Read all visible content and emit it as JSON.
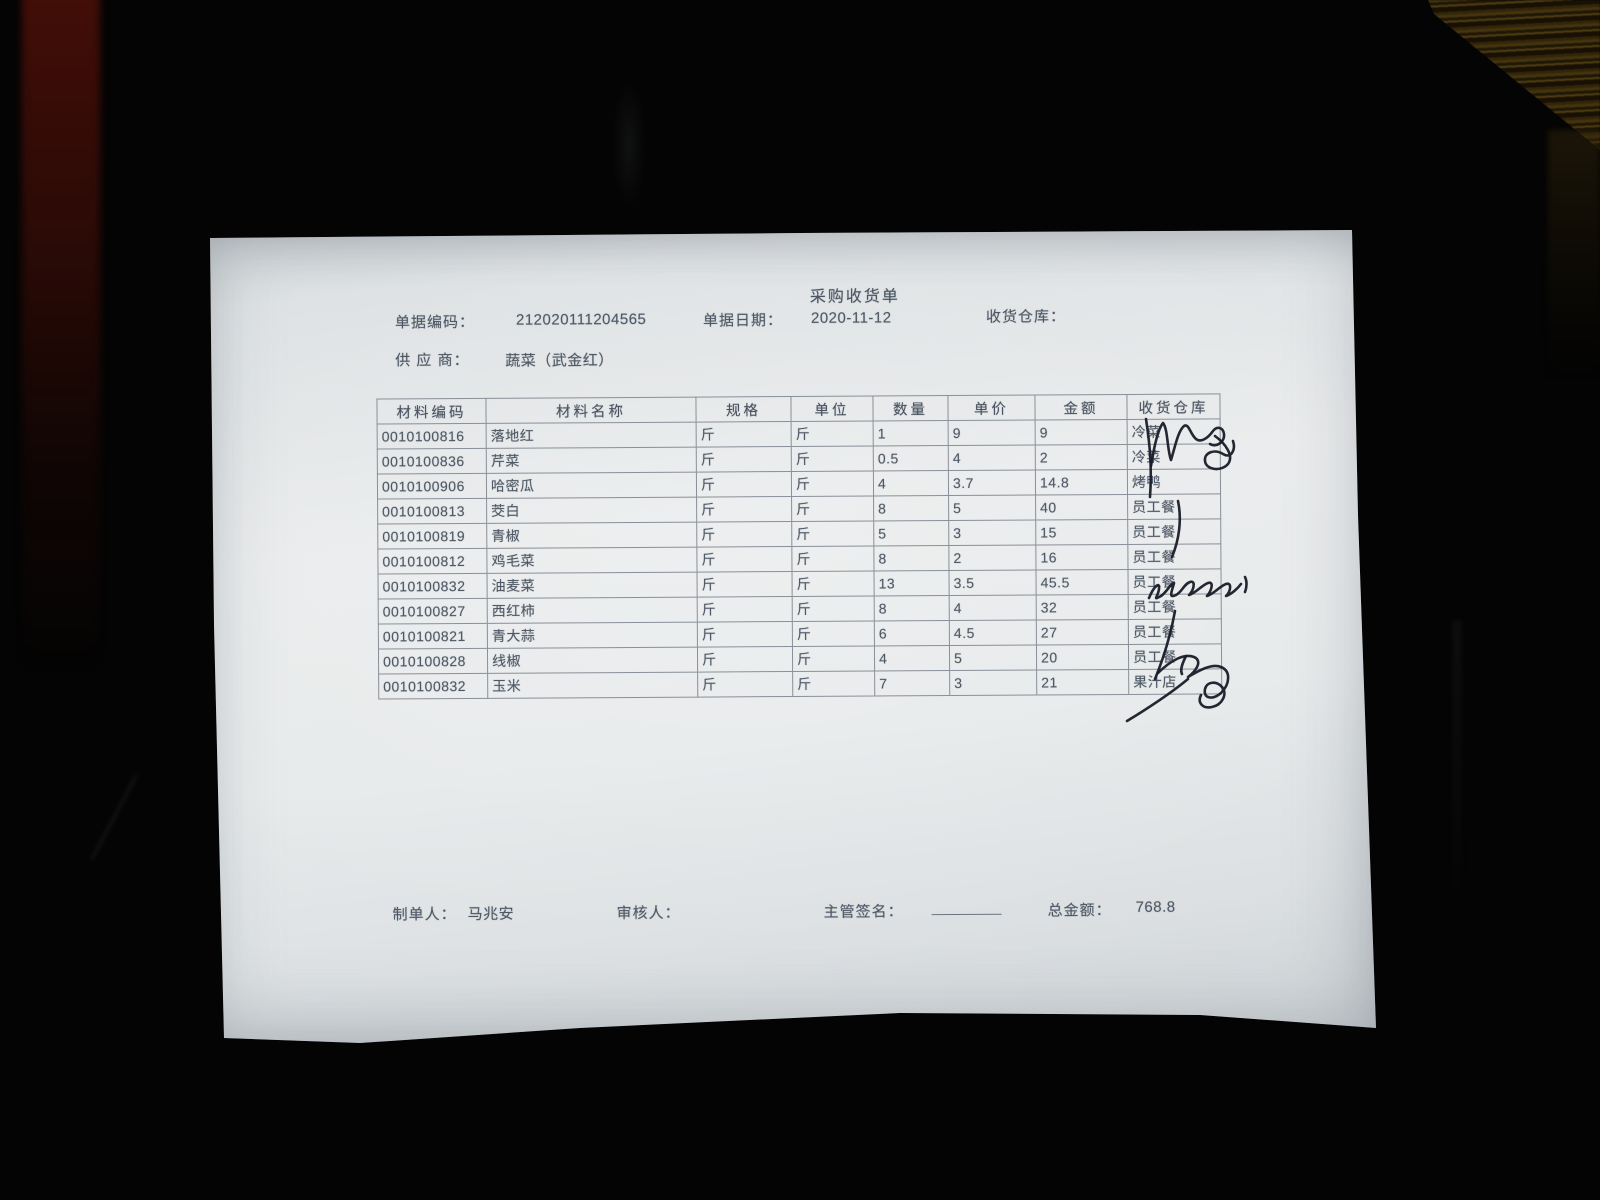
{
  "document": {
    "title": "采购收货单",
    "fields": {
      "doc_code_label": "单据编码：",
      "doc_code": "212020111204565",
      "doc_date_label": "单据日期：",
      "doc_date": "2020-11-12",
      "warehouse_label": "收货仓库：",
      "warehouse_value": "",
      "supplier_label": "供 应 商：",
      "supplier_value": "蔬菜（武金红）"
    },
    "table": {
      "headers": [
        "材料编码",
        "材料名称",
        "规格",
        "单位",
        "数量",
        "单价",
        "金额",
        "收货仓库"
      ],
      "rows": [
        [
          "0010100816",
          "落地红",
          "斤",
          "斤",
          "1",
          "9",
          "9",
          "冷菜"
        ],
        [
          "0010100836",
          "芹菜",
          "斤",
          "斤",
          "0.5",
          "4",
          "2",
          "冷菜"
        ],
        [
          "0010100906",
          "哈密瓜",
          "斤",
          "斤",
          "4",
          "3.7",
          "14.8",
          "烤鸭"
        ],
        [
          "0010100813",
          "茭白",
          "斤",
          "斤",
          "8",
          "5",
          "40",
          "员工餐"
        ],
        [
          "0010100819",
          "青椒",
          "斤",
          "斤",
          "5",
          "3",
          "15",
          "员工餐"
        ],
        [
          "0010100812",
          "鸡毛菜",
          "斤",
          "斤",
          "8",
          "2",
          "16",
          "员工餐"
        ],
        [
          "0010100832",
          "油麦菜",
          "斤",
          "斤",
          "13",
          "3.5",
          "45.5",
          "员工餐"
        ],
        [
          "0010100827",
          "西红柿",
          "斤",
          "斤",
          "8",
          "4",
          "32",
          "员工餐"
        ],
        [
          "0010100821",
          "青大蒜",
          "斤",
          "斤",
          "6",
          "4.5",
          "27",
          "员工餐"
        ],
        [
          "0010100828",
          "线椒",
          "斤",
          "斤",
          "4",
          "5",
          "20",
          "员工餐"
        ],
        [
          "0010100832",
          "玉米",
          "斤",
          "斤",
          "7",
          "3",
          "21",
          "果汁店"
        ]
      ]
    },
    "footer": {
      "preparer_label": "制单人：",
      "preparer": "马兆安",
      "reviewer_label": "审核人：",
      "reviewer": "",
      "manager_sign_label": "主管签名：",
      "total_label": "总金额：",
      "total": "768.8"
    },
    "annotations": [
      "handwritten-signature-over-rows-1-2",
      "pen-stroke-rows-3-5",
      "handwritten-name-row-7",
      "pen-stroke-rows-8-10",
      "handwritten-signature-row-11"
    ]
  },
  "colors": {
    "background": "#040404",
    "paper": "#e7eaeb",
    "print_ink": "#4f5966",
    "pen_ink": "#191c28",
    "table_border": "#8a9099",
    "wood_texture": "#4e3c12",
    "red_object": "#4a0f08"
  }
}
